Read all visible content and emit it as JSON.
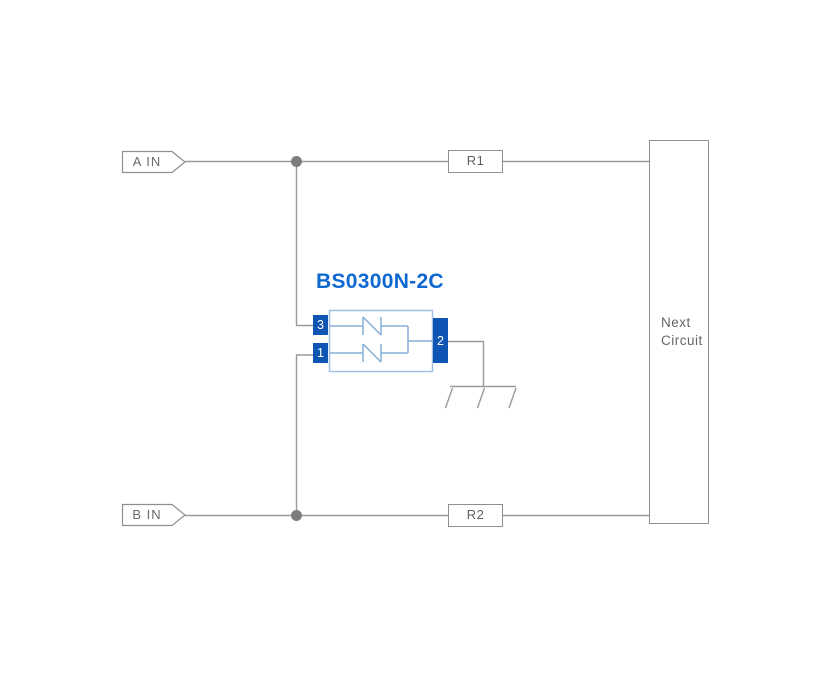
{
  "diagram": {
    "component": {
      "name": "BS0300N-2C",
      "pins": {
        "p3": "3",
        "p1": "1",
        "p2": "2"
      }
    },
    "inputs": {
      "a": "A IN",
      "b": "B IN"
    },
    "resistors": {
      "r1": "R1",
      "r2": "R2"
    },
    "next_circuit": {
      "line1": "Next",
      "line2": "Circuit"
    },
    "colors": {
      "wire": "#9a9a9a",
      "junction": "#7d7d7d",
      "box_border": "#8f8f8f",
      "component_border": "#a2c0e6",
      "component_line": "#86add9",
      "pin_fill": "#0f56b4",
      "title_blue": "#0d68d1",
      "label_text": "#6b6b6b"
    }
  }
}
